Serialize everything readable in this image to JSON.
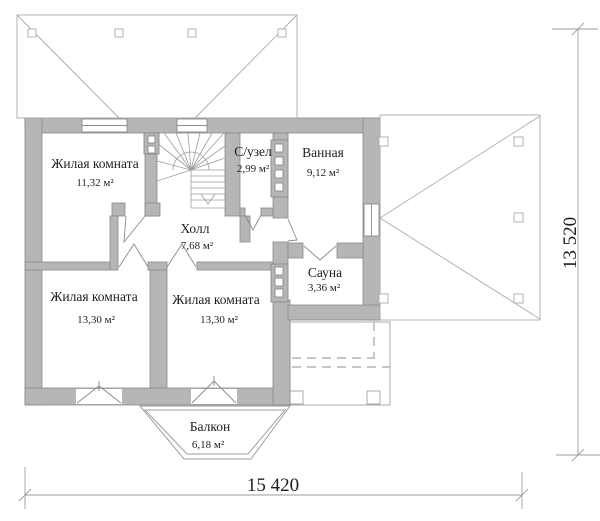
{
  "plan": {
    "rooms": [
      {
        "id": "living-top",
        "name": "Жилая комната",
        "area": "11,32 м²"
      },
      {
        "id": "wc",
        "name": "С/узел",
        "area": "2,99 м²"
      },
      {
        "id": "bathroom",
        "name": "Ванная",
        "area": "9,12 м²"
      },
      {
        "id": "hall",
        "name": "Холл",
        "area": "7,68 м²"
      },
      {
        "id": "sauna",
        "name": "Сауна",
        "area": "3,36 м²"
      },
      {
        "id": "living-bottom-left",
        "name": "Жилая комната",
        "area": "13,30 м²"
      },
      {
        "id": "living-bottom-right",
        "name": "Жилая комната",
        "area": "13,30 м²"
      },
      {
        "id": "balcony",
        "name": "Балкон",
        "area": "6,18 м²"
      }
    ],
    "dimensions": {
      "width_label": "15 420",
      "height_label": "13 520"
    },
    "colors": {
      "wall_fill": "#b6b6b6",
      "wall_stroke": "#8a8a8a",
      "thin_line": "#9e9e9e",
      "roof_line": "#ababab",
      "text": "#1f1f1f"
    }
  }
}
